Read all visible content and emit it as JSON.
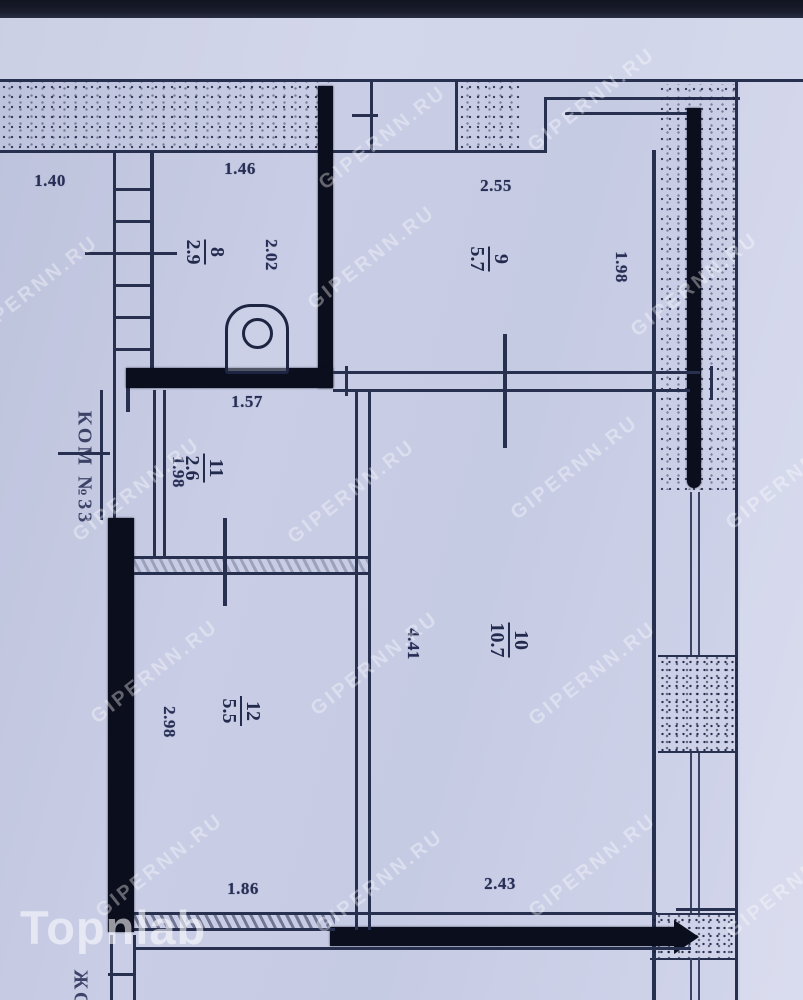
{
  "watermarks": {
    "site": "GIPERNN.RU",
    "brand": "Topnlab"
  },
  "annotations": {
    "block_label": "КОМ №33",
    "bottom_partial_label": "ЖО"
  },
  "rooms": [
    {
      "number": "8",
      "area": "2.9"
    },
    {
      "number": "9",
      "area": "5.7"
    },
    {
      "number": "11",
      "area": "2.6"
    },
    {
      "number": "10",
      "area": "10.7"
    },
    {
      "number": "12",
      "area": "5.5"
    }
  ],
  "dimensions": [
    {
      "label": "1.40"
    },
    {
      "label": "1.46"
    },
    {
      "label": "2.55"
    },
    {
      "label": "1.98"
    },
    {
      "label": "2.02"
    },
    {
      "label": "1.57"
    },
    {
      "label": "1.98"
    },
    {
      "label": "4.41"
    },
    {
      "label": "2.98"
    },
    {
      "label": "1.86"
    },
    {
      "label": "2.43"
    }
  ]
}
